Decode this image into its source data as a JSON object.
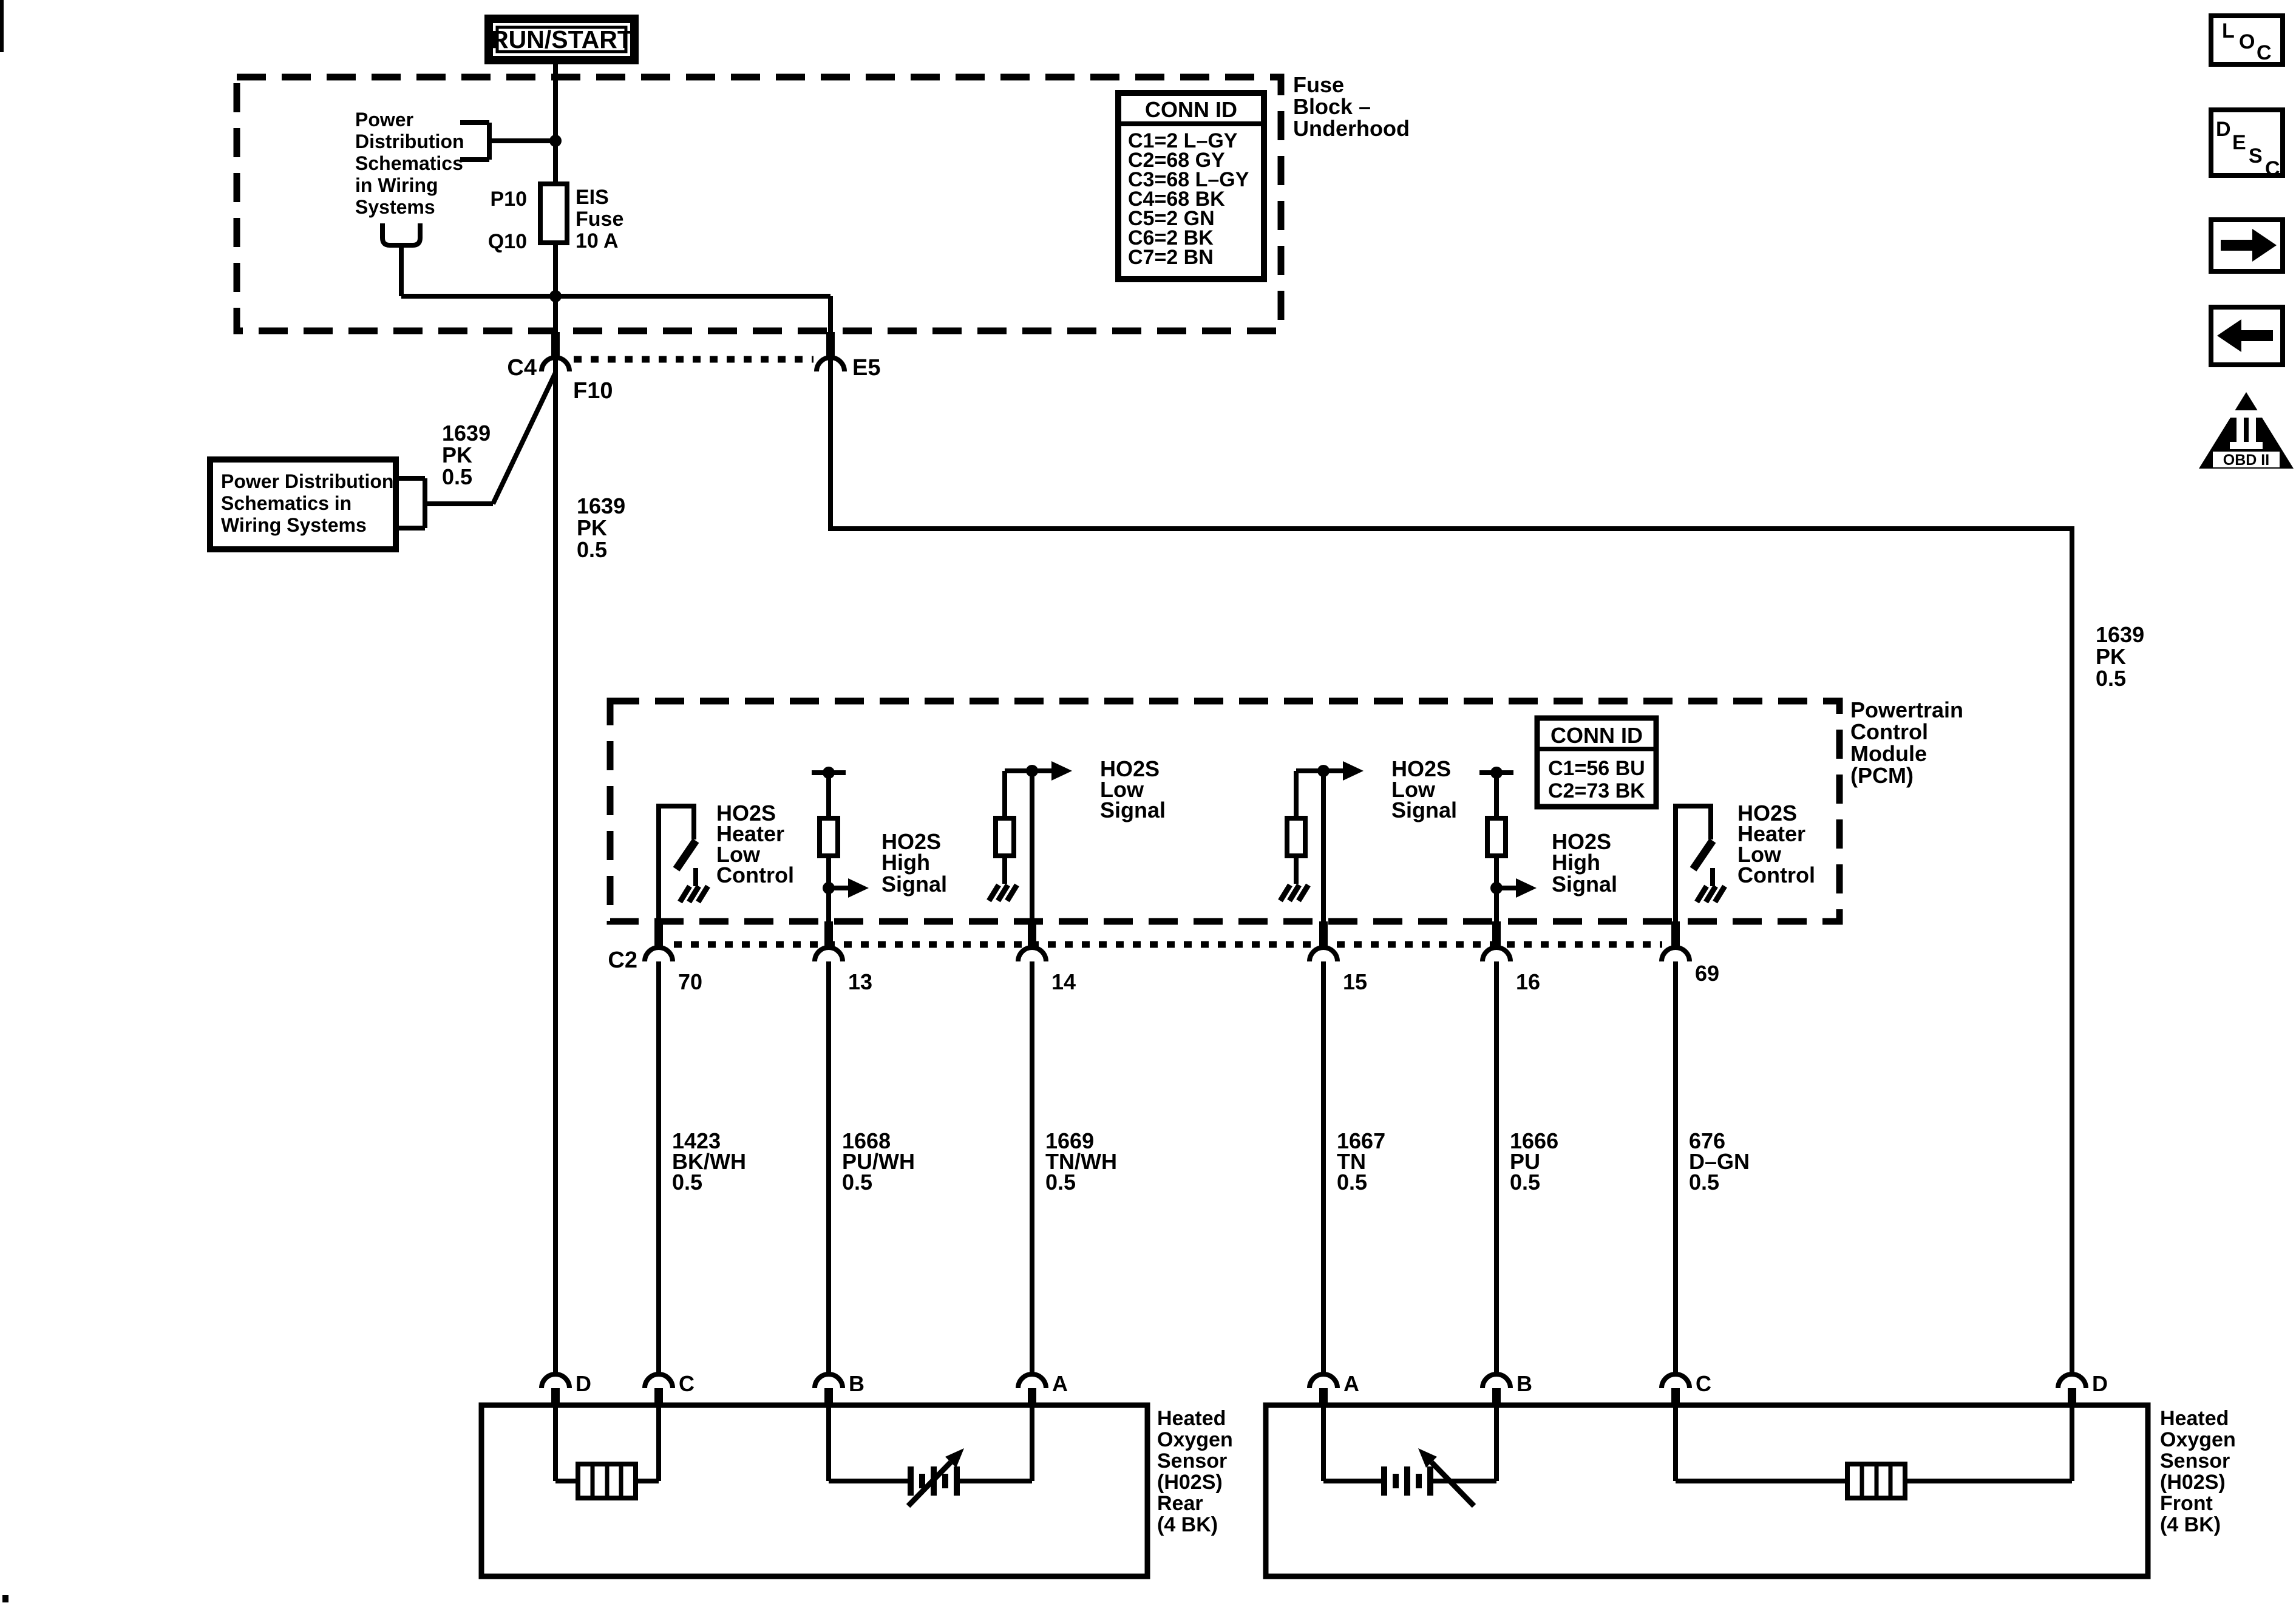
{
  "ignition": {
    "label": "RUN/START"
  },
  "fuse_block": {
    "title_lines": [
      "Fuse",
      "Block –",
      "Underhood"
    ],
    "power_ref_lines": [
      "Power",
      "Distribution",
      "Schematics",
      "in Wiring",
      "Systems"
    ],
    "fuse_pin_top": "P10",
    "fuse_pin_bottom": "Q10",
    "fuse_desc_lines": [
      "EIS",
      "Fuse",
      "10 A"
    ],
    "conn_table": {
      "title": "CONN ID",
      "rows": [
        "C1=2 L–GY",
        "C2=68 GY",
        "C3=68 L–GY",
        "C4=68 BK",
        "C5=2 GN",
        "C6=2 BK",
        "C7=2 BN"
      ]
    },
    "pin_c4": "C4",
    "pin_f10": "F10",
    "pin_e5": "E5"
  },
  "power_ref_box": {
    "lines": [
      "Power Distribution",
      "Schematics in",
      "Wiring Systems"
    ]
  },
  "circuit_1639": {
    "lines": [
      "1639",
      "PK",
      "0.5"
    ]
  },
  "pcm": {
    "title_lines": [
      "Powertrain",
      "Control",
      "Module",
      "(PCM)"
    ],
    "conn_table": {
      "title": "CONN ID",
      "rows": [
        "C1=56 BU",
        "C2=73 BK"
      ]
    },
    "connector_label": "C2",
    "pins": [
      "70",
      "13",
      "14",
      "15",
      "16",
      "69"
    ],
    "heater_low_lines": [
      "HO2S",
      "Heater",
      "Low",
      "Control"
    ],
    "high_signal_lines": [
      "HO2S",
      "High",
      "Signal"
    ],
    "low_signal_lines": [
      "HO2S",
      "Low",
      "Signal"
    ]
  },
  "wires": [
    [
      "1423",
      "BK/WH",
      "0.5"
    ],
    [
      "1668",
      "PU/WH",
      "0.5"
    ],
    [
      "1669",
      "TN/WH",
      "0.5"
    ],
    [
      "1667",
      "TN",
      "0.5"
    ],
    [
      "1666",
      "PU",
      "0.5"
    ],
    [
      "676",
      "D–GN",
      "0.5"
    ]
  ],
  "sensor_rear": {
    "title_lines": [
      "Heated",
      "Oxygen",
      "Sensor",
      "(H02S)",
      "Rear",
      "(4 BK)"
    ],
    "pins": [
      "D",
      "C",
      "B",
      "A"
    ]
  },
  "sensor_front": {
    "title_lines": [
      "Heated",
      "Oxygen",
      "Sensor",
      "(H02S)",
      "Front",
      "(4 BK)"
    ],
    "pins": [
      "A",
      "B",
      "C",
      "D"
    ]
  },
  "toolbar": {
    "loc": [
      "L",
      "O",
      "C"
    ],
    "desc": [
      "D",
      "E",
      "S",
      "C"
    ],
    "obd": "OBD II"
  },
  "colors": {
    "ink": "#000000",
    "paper": "#ffffff"
  }
}
